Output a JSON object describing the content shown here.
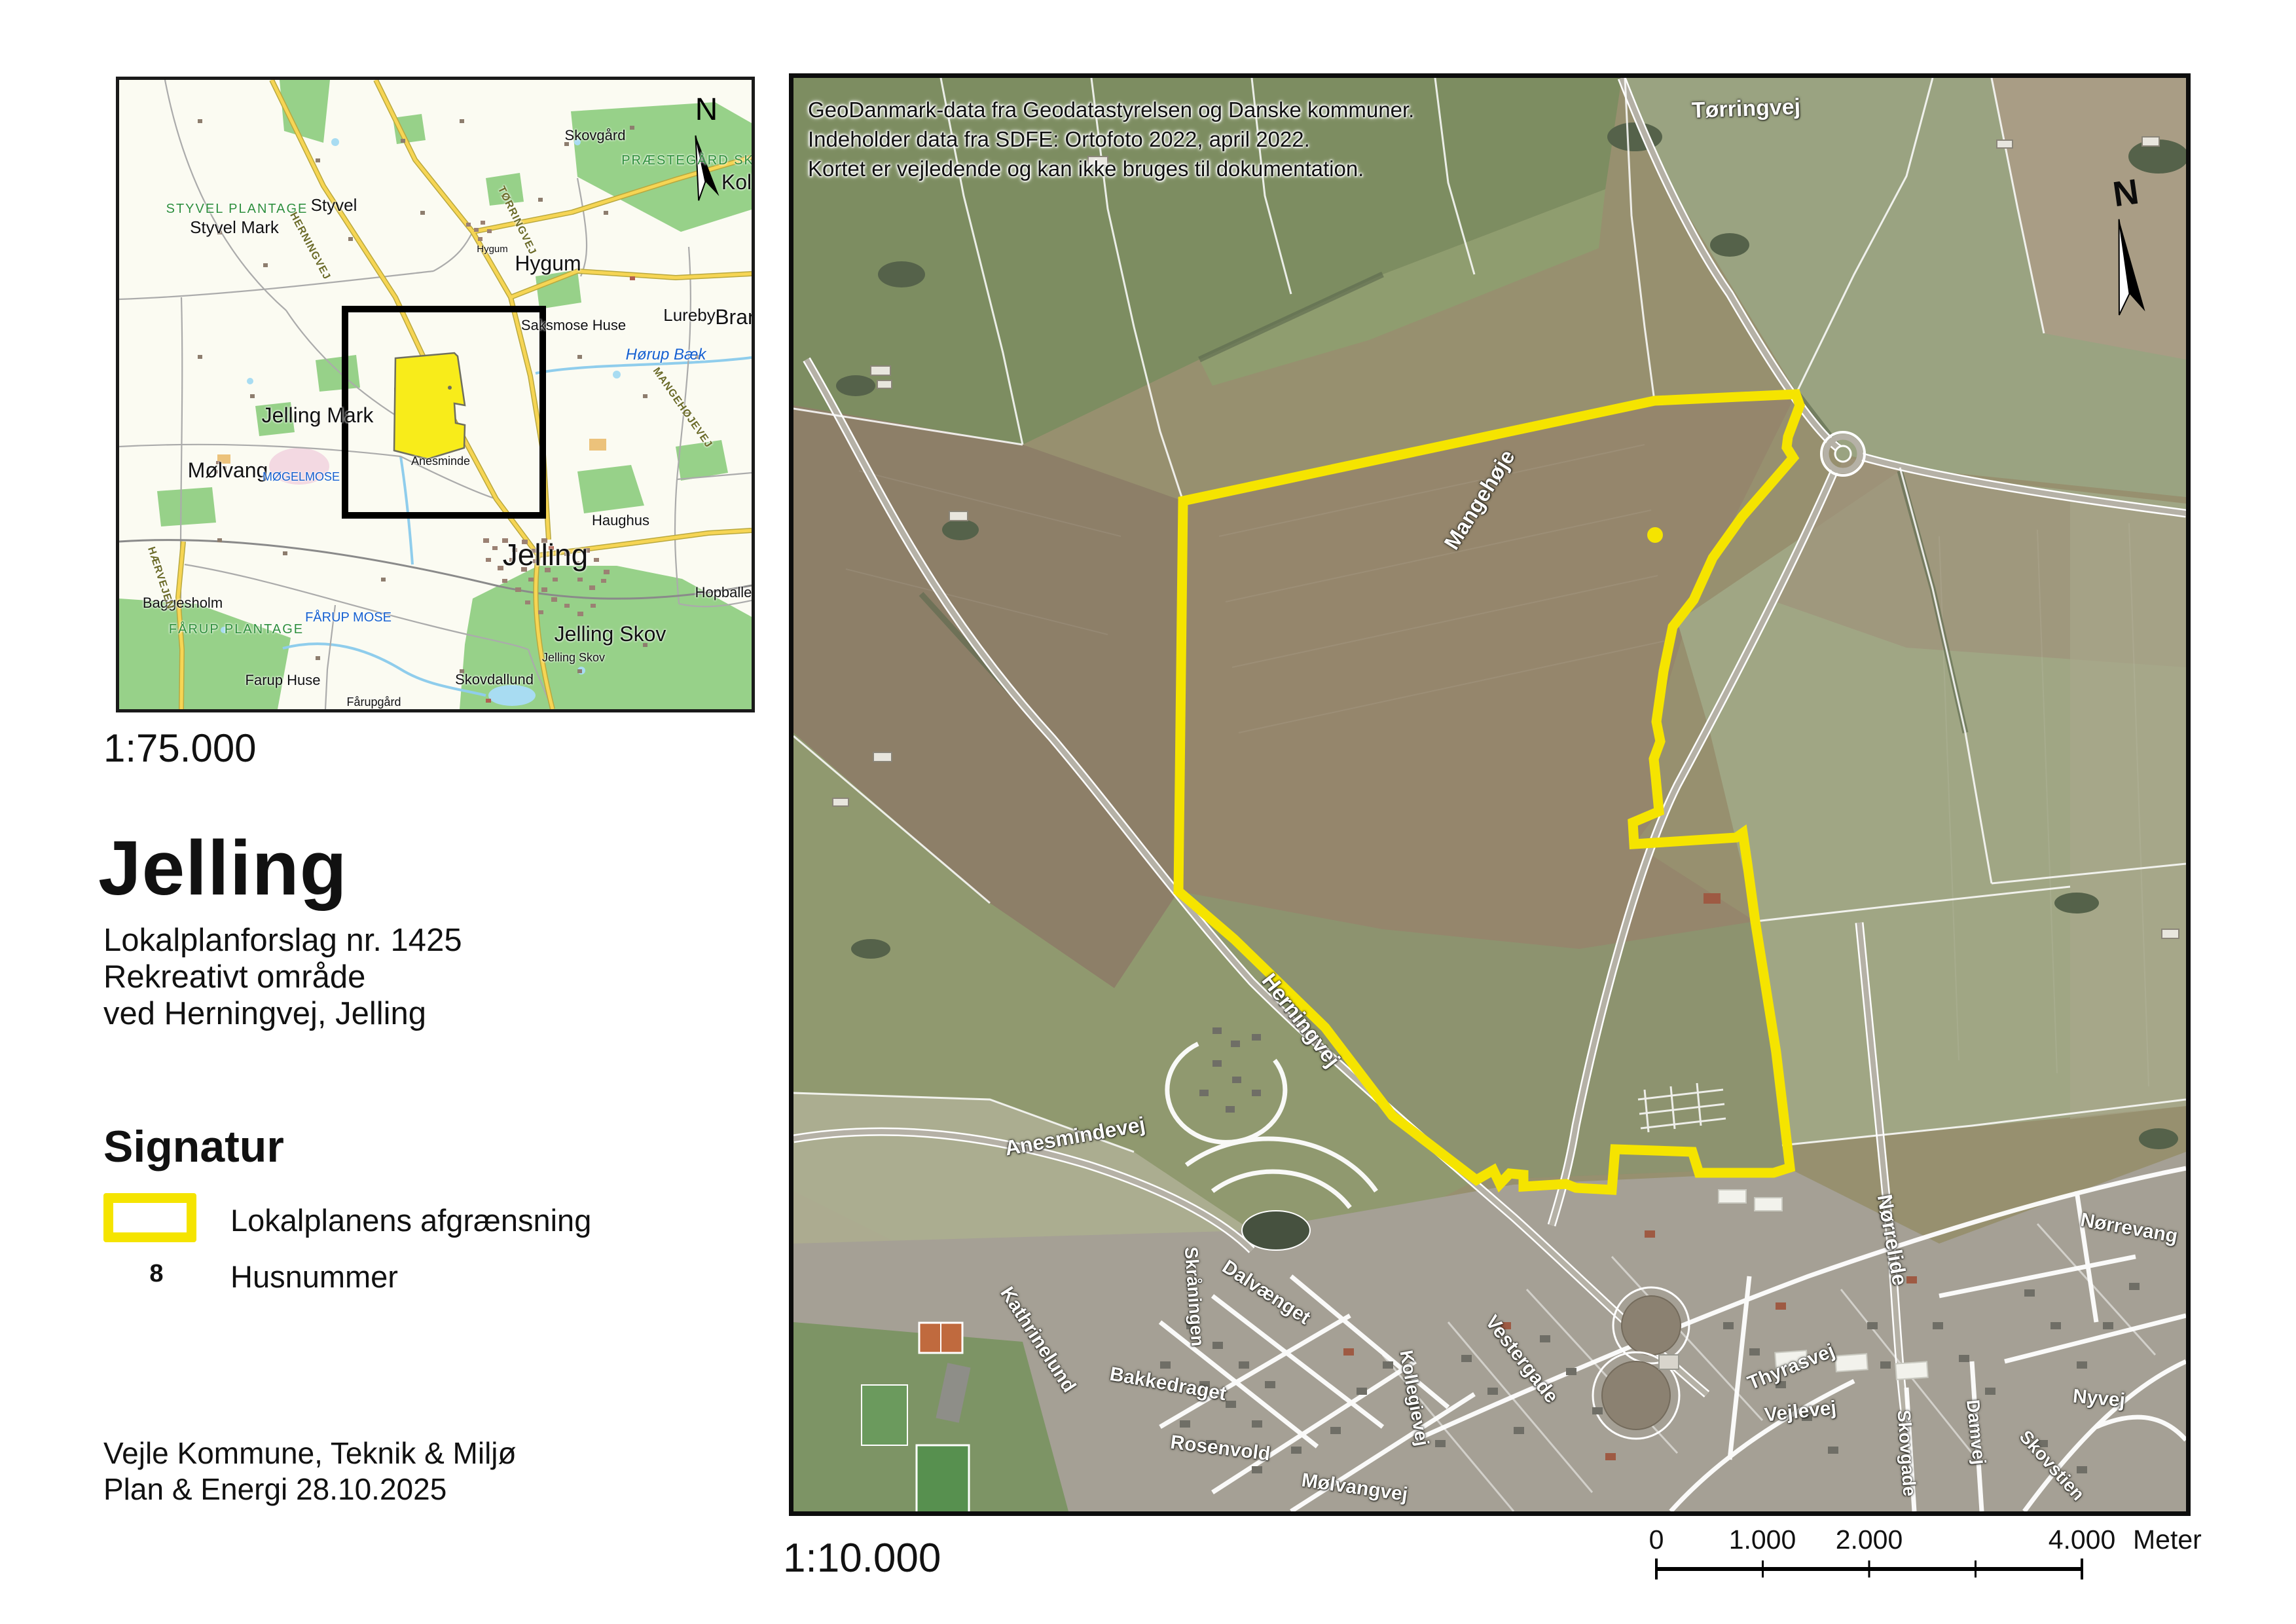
{
  "left_panel": {
    "minimap_scale": "1:75.000",
    "title": "Jelling",
    "subtitle1": "Lokalplanforslag nr. 1425",
    "subtitle2": "Rekreativt område",
    "subtitle3": "ved Herningvej, Jelling",
    "legend_heading": "Signatur",
    "legend_area_label": "Lokalplanens afgrænsning",
    "legend_house_symbol": "8",
    "legend_house_label": "Husnummer",
    "footer1": "Vejle Kommune, Teknik & Miljø",
    "footer2": "Plan & Energi 28.10.2025",
    "colors": {
      "boundary_yellow": "#f5e400",
      "frame_black": "#0d0d0d"
    }
  },
  "minimap": {
    "north": "N",
    "labels": {
      "skovgaard": "Skovgård",
      "praestegaard_skov": "PRÆSTEGÅRD SKOV",
      "kol": "Kol",
      "styvel": "Styvel",
      "styvel_mark": "Styvel Mark",
      "styvel_plantage": "STYVEL PLANTAGE",
      "hygum": "Hygum",
      "hygum_small": "Hygum",
      "saksmose": "Saksmose Huse",
      "lureby": "Lureby",
      "bran": "Bran",
      "hoerup_baek": "Hørup Bæk",
      "jelling_mark": "Jelling Mark",
      "moelvang": "Mølvang",
      "moegelmose": "MØGELMOSE",
      "anesminde": "Anesminde",
      "jelling_town": "Jelling",
      "haughus": "Haughus",
      "hopballe": "Hopballe",
      "jelling_skov": "Jelling Skov",
      "jelling_skov_small": "Jelling Skov",
      "baggesholm": "Baggesholm",
      "faarup_plantage": "FÅRUP PLANTAGE",
      "faarup_mose": "FÅRUP MOSE",
      "farup_huse": "Farup Huse",
      "skovdallund": "Skovdallund",
      "faarupgaard": "Fårupgård",
      "herningvej_road": "HERNINGVEJ",
      "toerringvej_road": "TØRRINGVEJ",
      "mangehoejevej_road": "MANGEHØJEVEJ",
      "haervejen_road": "HÆRVEJEN"
    }
  },
  "aerial": {
    "attribution1": "GeoDanmark-data fra Geodatastyrelsen og Danske kommuner.",
    "attribution2": "Indeholder data fra SDFE: Ortofoto 2022, april 2022.",
    "attribution3": "Kortet er vejledende og kan ikke bruges til dokumentation.",
    "north": "N",
    "scale_text": "1:10.000",
    "labels": {
      "toerringvej": "Tørringvej",
      "mangehoeje": "Mangehøje",
      "herningvej": "Herningvej",
      "anesmindevej": "Anesmindevej",
      "kathrinelund": "Kathrinelund",
      "skraaningen": "Skråningen",
      "dalvaenget": "Dalvænget",
      "bakkedraget": "Bakkedraget",
      "rosenvold": "Rosenvold",
      "moelvangvej": "Mølvangvej",
      "kollegievej": "Kollegievej",
      "vestergade": "Vestergade",
      "noerrelide": "Nørrelide",
      "noerrevang": "Nørrevang",
      "thyrasvej": "Thyrasvej",
      "vejlevej": "Vejlevej",
      "skovgade": "Skovgade",
      "damvej": "Damvej",
      "skovstien": "Skovstien",
      "nyvej": "Nyvej"
    },
    "scalebar": {
      "t0": "0",
      "t1": "1.000",
      "t2": "2.000",
      "t4": "4.000",
      "unit": "Meter"
    }
  }
}
